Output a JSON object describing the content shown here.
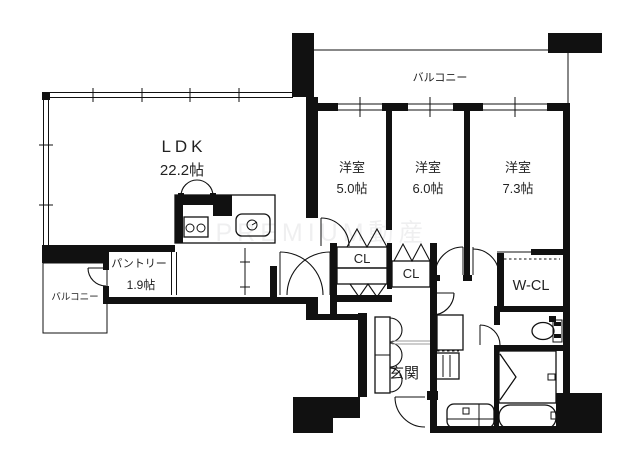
{
  "watermark": "PREMIUM動産",
  "balcony_top": {
    "label": "バルコニー"
  },
  "balcony_left": {
    "label": "バルコニー"
  },
  "ldk": {
    "label": "LDK",
    "size": "22.2帖"
  },
  "bedroom1": {
    "label": "洋室",
    "size": "5.0帖"
  },
  "bedroom2": {
    "label": "洋室",
    "size": "6.0帖"
  },
  "bedroom3": {
    "label": "洋室",
    "size": "7.3帖"
  },
  "pantry": {
    "label": "パントリー",
    "size": "1.9帖"
  },
  "closet1": {
    "label": "CL"
  },
  "closet2": {
    "label": "CL"
  },
  "walk_in_closet": {
    "label": "W-CL"
  },
  "entrance": {
    "label": "玄関"
  },
  "colors": {
    "wall": "#111111",
    "shower_floor": "#e6e6e6",
    "stove": "#bdbdbd",
    "washer": "#d7e6f4",
    "vanity": "#ecece4",
    "watermark": "#6b7075"
  }
}
